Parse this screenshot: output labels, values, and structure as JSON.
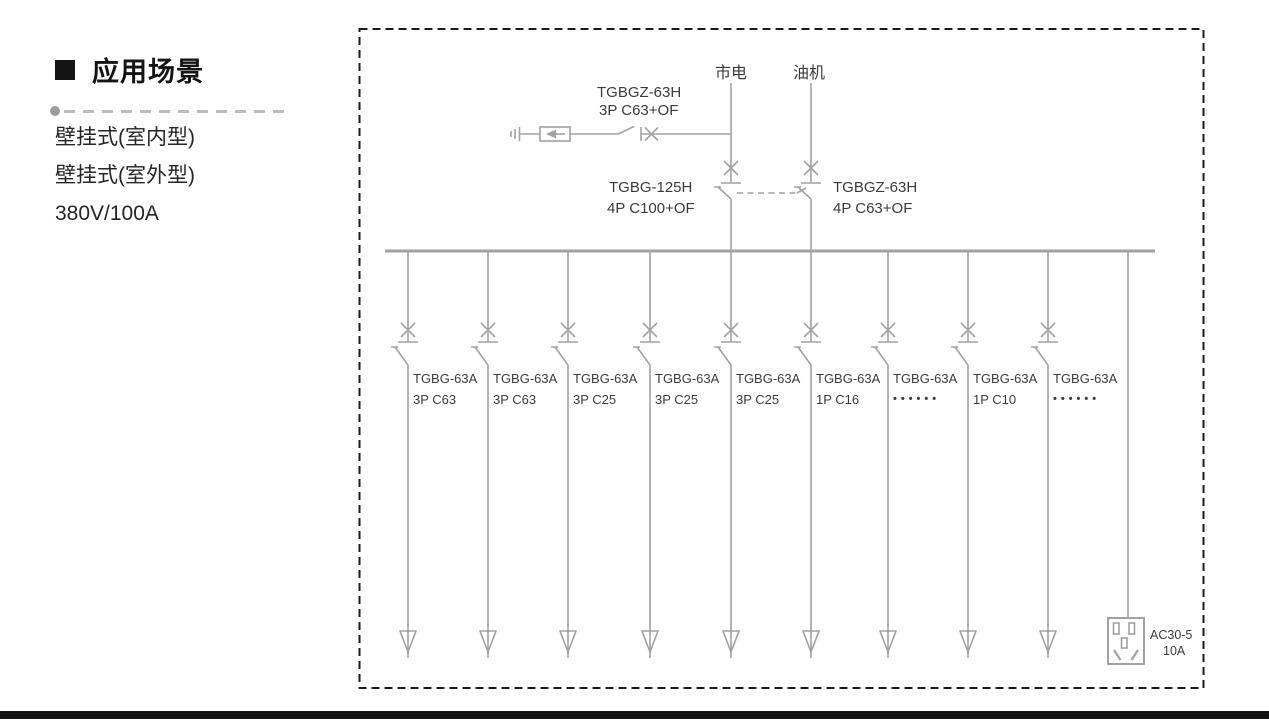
{
  "left_panel": {
    "title": "应用场景",
    "specs": [
      "壁挂式(室内型)",
      "壁挂式(室外型)",
      "380V/100A"
    ]
  },
  "diagram": {
    "sources": [
      {
        "label": "市电"
      },
      {
        "label": "油机"
      }
    ],
    "spd_branch": {
      "model": "TGBGZ-63H",
      "spec": "3P C63+OF"
    },
    "main_breaker_left": {
      "model": "TGBG-125H",
      "spec": "4P C100+OF"
    },
    "main_breaker_right": {
      "model": "TGBGZ-63H",
      "spec": "4P C63+OF"
    },
    "branches": [
      {
        "model": "TGBG-63A",
        "spec": "3P C63"
      },
      {
        "model": "TGBG-63A",
        "spec": "3P C63"
      },
      {
        "model": "TGBG-63A",
        "spec": "3P C25"
      },
      {
        "model": "TGBG-63A",
        "spec": "3P C25"
      },
      {
        "model": "TGBG-63A",
        "spec": "3P C25"
      },
      {
        "model": "TGBG-63A",
        "spec": "1P C16"
      },
      {
        "model": "TGBG-63A",
        "spec": "••••••"
      },
      {
        "model": "TGBG-63A",
        "spec": "1P C10"
      },
      {
        "model": "TGBG-63A",
        "spec": "••••••"
      }
    ],
    "socket": {
      "model": "AC30-5",
      "rating": "10A"
    }
  },
  "icons": {
    "section_bullet": "black-square",
    "ground": "ground-symbol",
    "spd": "surge-arrester-box-arrow",
    "breaker": "circuit-breaker-x-blade",
    "interlock": "dashed-mechanical-link",
    "load_arrow": "open-triangle-arrow",
    "socket": "five-hole-socket"
  },
  "colors": {
    "line_gray": "#a2a2a2",
    "text_dark": "#3b3b3b",
    "border_black": "#1c1c1c"
  }
}
